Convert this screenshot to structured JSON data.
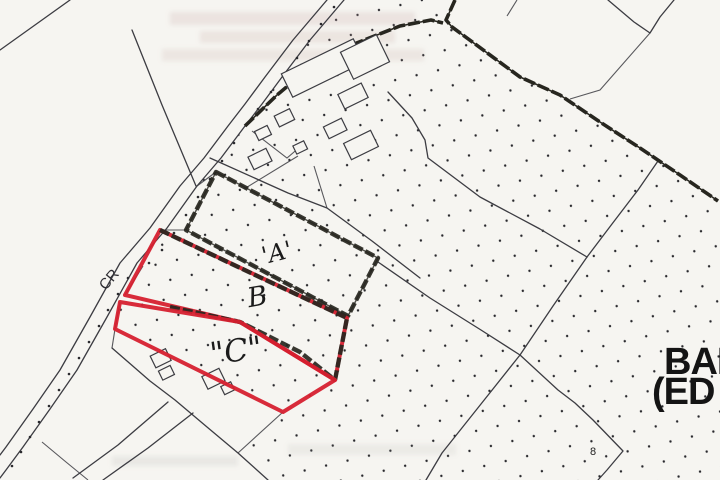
{
  "title": "Scanned site location plan",
  "map": {
    "road_label": "CR",
    "plots": [
      {
        "id": "plot-a",
        "label": "'A'",
        "outline": "black-hatched"
      },
      {
        "id": "plot-b",
        "label": "B",
        "outline": "red-and-hatched"
      },
      {
        "id": "plot-c",
        "label": "\"C\"",
        "outline": "red"
      }
    ],
    "parcel_number": "8",
    "place_name": {
      "line1": "BAR",
      "line2": "(ED"
    }
  },
  "colors": {
    "paper": "#f6f5f1",
    "line": "#3c3c42",
    "boundary-dark": "#27261f",
    "outline-red": "#d6202f",
    "stipple": "#28282c",
    "label-ink": "#1b1b1b"
  }
}
